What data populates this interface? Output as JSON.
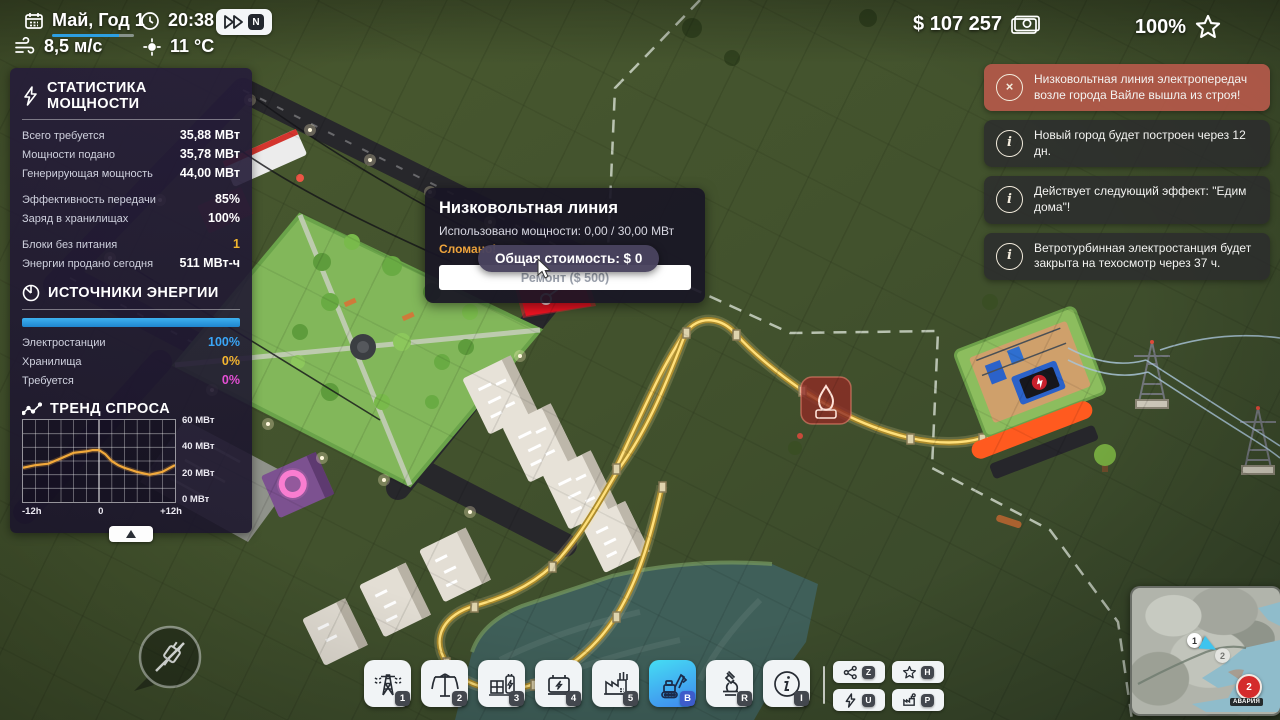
{
  "topbar": {
    "date": "Май, Год 1",
    "time": "20:38",
    "speed_badge": "N",
    "wind": "8,5 м/с",
    "temperature": "11 °C",
    "money": "$ 107 257",
    "approval": "100%"
  },
  "power_stats": {
    "title": "СТАТИСТИКА МОЩНОСТИ",
    "rows": [
      {
        "label": "Всего требуется",
        "value": "35,88 МВт"
      },
      {
        "label": "Мощности подано",
        "value": "35,78 МВт"
      },
      {
        "label": "Генерирующая мощность",
        "value": "44,00 МВт"
      },
      {
        "label": "Эффективность передачи",
        "value": "85%"
      },
      {
        "label": "Заряд в хранилищах",
        "value": "100%"
      },
      {
        "label": "Блоки без питания",
        "value": "1"
      },
      {
        "label": "Энергии продано сегодня",
        "value": "511 МВт-ч"
      }
    ]
  },
  "energy_sources": {
    "title": "ИСТОЧНИКИ ЭНЕРГИИ",
    "bar_percent": 100,
    "rows": [
      {
        "label": "Электростанции",
        "value": "100%",
        "color": "#3aa6f7"
      },
      {
        "label": "Хранилища",
        "value": "0%",
        "color": "#f3b62e"
      },
      {
        "label": "Требуется",
        "value": "0%",
        "color": "#e44fd4"
      }
    ]
  },
  "demand_trend": {
    "title": "ТРЕНД СПРОСА",
    "collapse_label": "collapse"
  },
  "chart_data": {
    "type": "line",
    "title": "ТРЕНД СПРОСА",
    "x": [
      -12,
      -10,
      -8,
      -6,
      -4,
      -2,
      -1,
      0,
      1,
      2,
      3,
      4,
      6,
      8,
      10,
      12
    ],
    "values": [
      25,
      27,
      28,
      32,
      36,
      37,
      38,
      38,
      35,
      30,
      27,
      25,
      22,
      20,
      22,
      27
    ],
    "xlim": [
      -12,
      12
    ],
    "ylim": [
      0,
      60
    ],
    "x_tick_labels": [
      "-12h",
      "0",
      "+12h"
    ],
    "y_tick_labels": [
      "60 МВт",
      "40 МВт",
      "20 МВт",
      "0 МВт"
    ],
    "ylabel_unit": "МВт",
    "series_color": "#f2a93b",
    "grid": true,
    "legend": "none"
  },
  "tooltip": {
    "title": "Низковольтная линия",
    "usage": "Использовано мощности: 0,00 / 30,00 МВт",
    "status": "Сломано!",
    "repair_button": "Ремонт ($ 500)",
    "cost_pill": "Общая стоимость: $ 0"
  },
  "notifications": [
    {
      "type": "error",
      "icon": "×",
      "text": "Низковольтная линия электропередач возле города Вайле вышла из строя!"
    },
    {
      "type": "info",
      "icon": "i",
      "text": "Новый город будет построен через 12 дн."
    },
    {
      "type": "info",
      "icon": "i",
      "text": "Действует следующий эффект: \"Едим дома\"!"
    },
    {
      "type": "info",
      "icon": "i",
      "text": "Ветротурбинная электростанция будет закрыта на техосмотр через 37 ч."
    }
  ],
  "toolbar": {
    "buttons": [
      {
        "name": "high-voltage-line",
        "shortcut": "1"
      },
      {
        "name": "low-voltage-line",
        "shortcut": "2"
      },
      {
        "name": "substation",
        "shortcut": "3"
      },
      {
        "name": "battery-storage",
        "shortcut": "4"
      },
      {
        "name": "factory",
        "shortcut": "5"
      },
      {
        "name": "bulldozer",
        "shortcut": "B",
        "selected": true
      },
      {
        "name": "research",
        "shortcut": "R"
      },
      {
        "name": "info",
        "shortcut": "I"
      }
    ],
    "side_buttons": [
      {
        "name": "network-overlay",
        "shortcut": "Z"
      },
      {
        "name": "favorites-overlay",
        "shortcut": "H"
      },
      {
        "name": "power-overlay",
        "shortcut": "U"
      },
      {
        "name": "production-overlay",
        "shortcut": "P"
      }
    ]
  },
  "minimap": {
    "marker1": "1",
    "marker2": "2",
    "alert_value": "2",
    "alert_label": "АВАРИЯ"
  }
}
